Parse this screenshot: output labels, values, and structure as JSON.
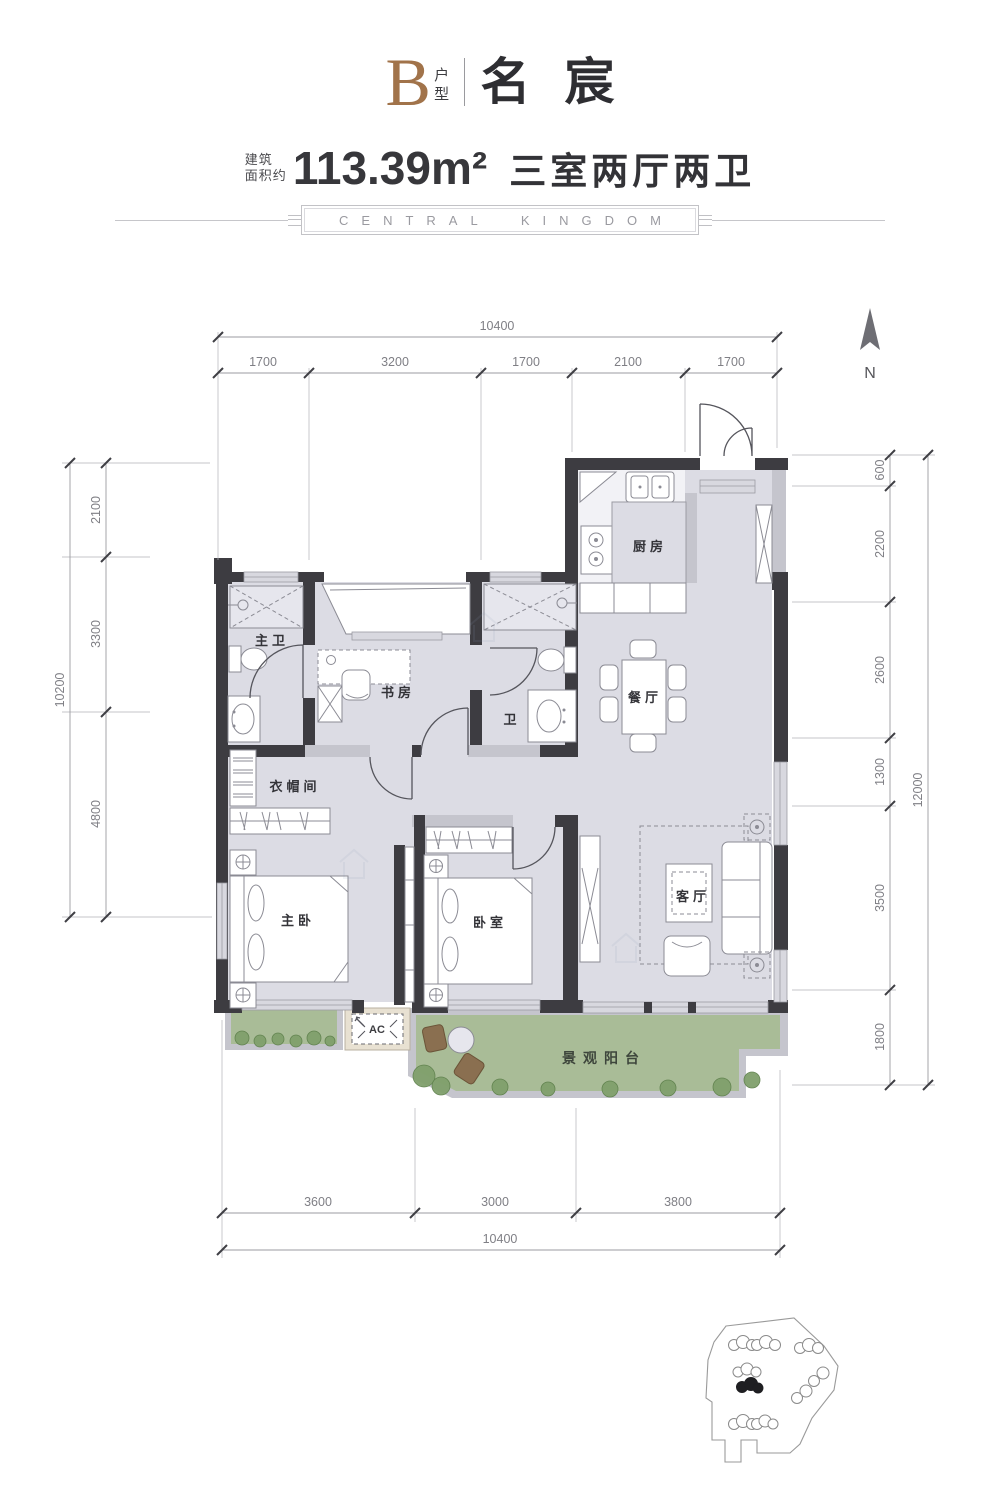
{
  "header": {
    "unit_letter": "B",
    "unit_suffix": "户型",
    "project_name": "名宸",
    "area_label_line1": "建筑",
    "area_label_line2": "面积约",
    "area_value": "113.39m²",
    "rooms_summary": "三室两厅两卫",
    "banner_text": "CENTRAL KINGDOM"
  },
  "compass": {
    "north": "N"
  },
  "dims": {
    "top": {
      "total": "10400",
      "segments": [
        "1700",
        "3200",
        "1700",
        "2100",
        "1700"
      ]
    },
    "left": {
      "total": "10200",
      "segments": [
        "2100",
        "3300",
        "4800"
      ]
    },
    "right": {
      "total": "12000",
      "segments": [
        "600",
        "2200",
        "2600",
        "1300",
        "3500",
        "1800"
      ]
    },
    "bottom": {
      "total": "10400",
      "segments": [
        "3600",
        "3000",
        "3800"
      ]
    }
  },
  "rooms": {
    "kitchen": "厨房",
    "dining": "餐厅",
    "study": "书房",
    "master_bath": "主卫",
    "bath": "卫",
    "cloakroom": "衣帽间",
    "master_bedroom": "主卧",
    "bedroom": "卧室",
    "living": "客厅",
    "balcony": "景观阳台",
    "ac_unit": "AC"
  },
  "colors": {
    "accent": "#a1734a",
    "wall": "#3d3c41",
    "floor": "#dcdce4",
    "balcony_green": "#a9bc97"
  }
}
